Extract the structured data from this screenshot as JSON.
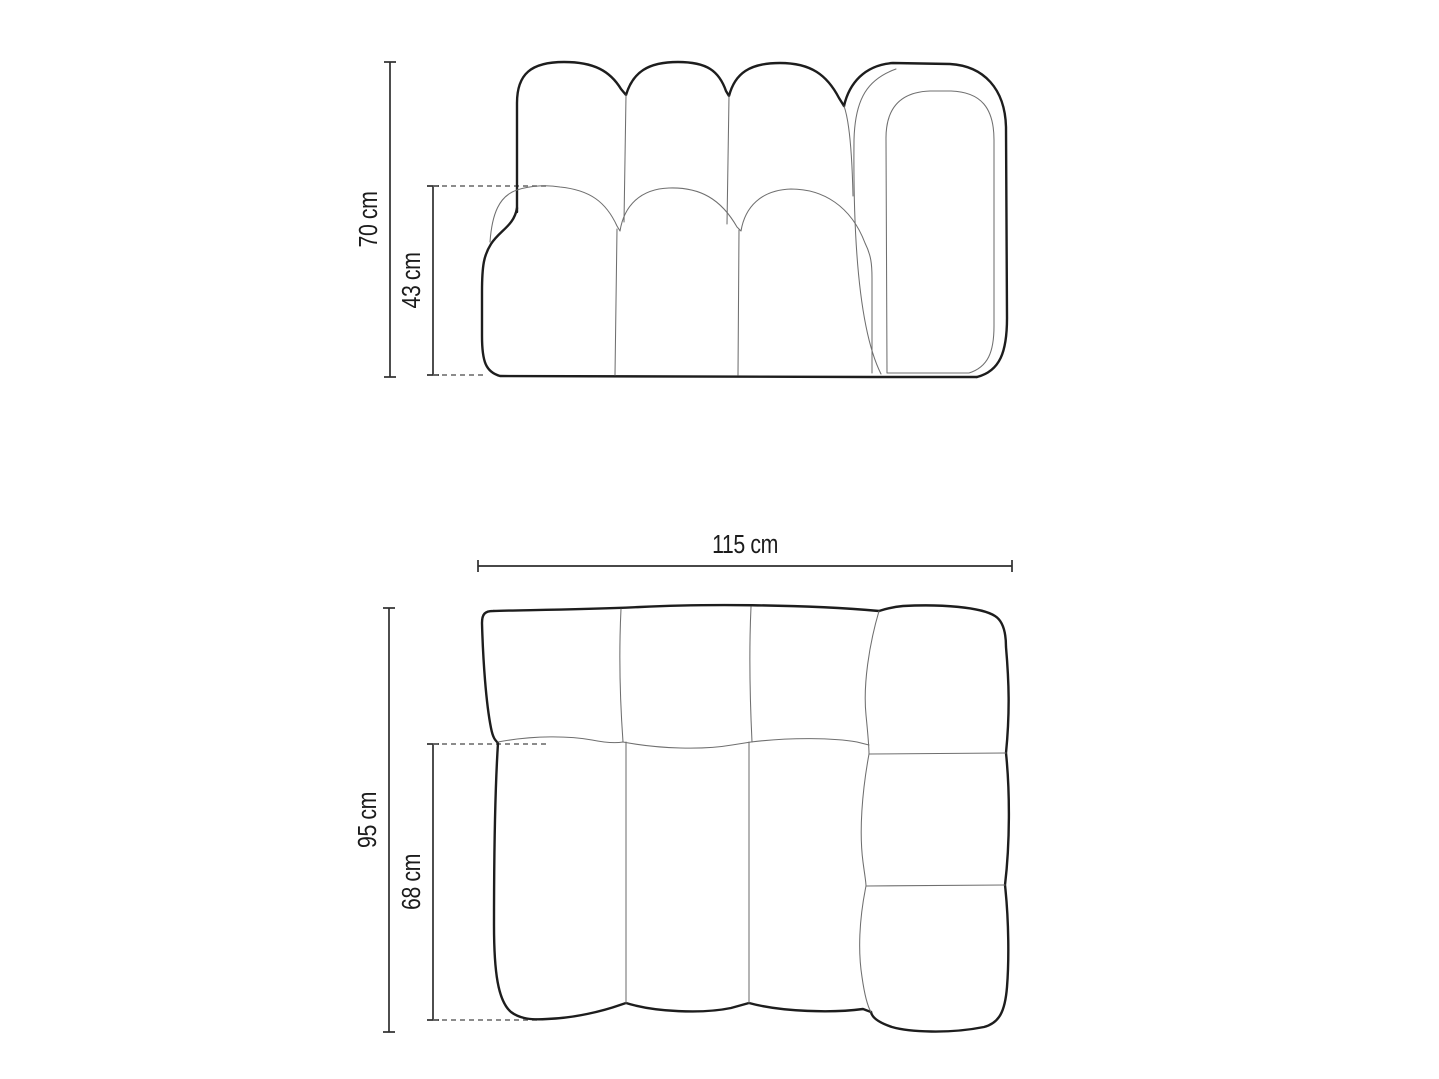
{
  "diagram": {
    "front_view": {
      "total_height_label": "70 cm",
      "seat_height_label": "43 cm"
    },
    "top_view": {
      "total_width_label": "115 cm",
      "total_depth_label": "95 cm",
      "seat_depth_label": "68 cm"
    },
    "colors": {
      "background": "#ffffff",
      "outline_bold": "#1d1d1d",
      "outline_thin": "#6f6f6f",
      "dimension": "#2e2e2e",
      "dashed": "#666666",
      "text": "#1c1c1c"
    }
  }
}
